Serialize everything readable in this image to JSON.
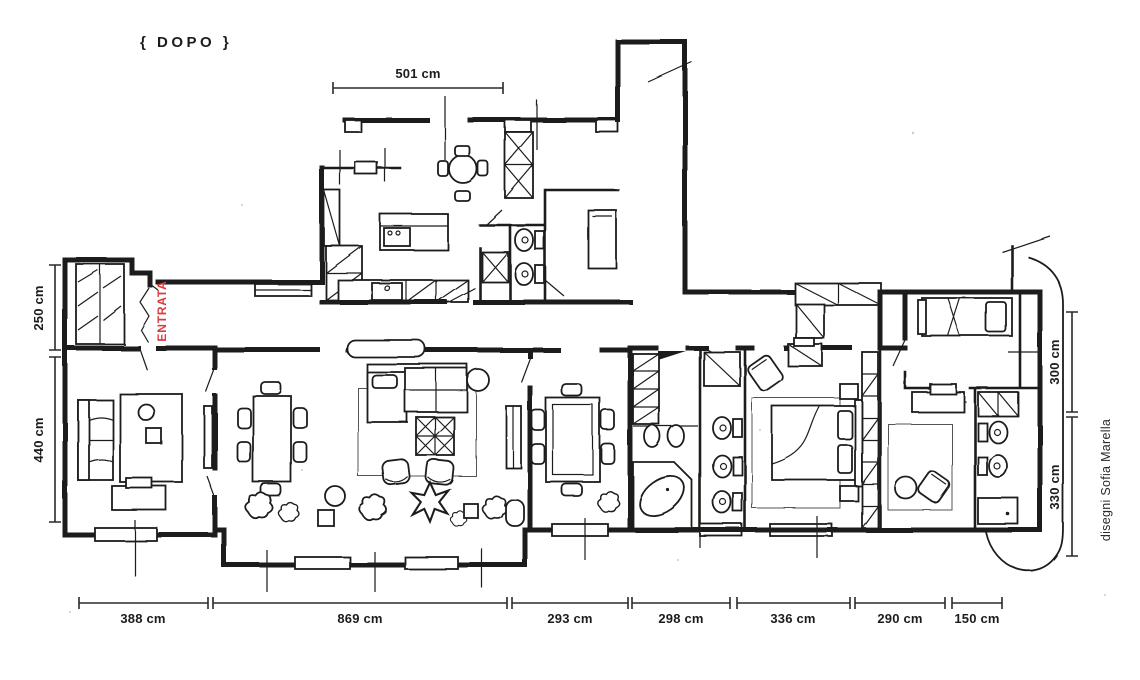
{
  "title": "{ DOPO }",
  "entrance_label": "ENTRATA",
  "credit": "disegni Sofia Marella",
  "unit": "cm",
  "colors": {
    "ink": "#1c1c1a",
    "accent_red": "#d93a42",
    "paper": "#ffffff"
  },
  "dimensions": {
    "top": "501 cm",
    "left_upper": "250 cm",
    "left_lower": "440 cm",
    "right_upper": "300 cm",
    "right_lower": "330 cm",
    "bottom": [
      "388 cm",
      "869 cm",
      "293 cm",
      "298 cm",
      "336 cm",
      "290 cm",
      "150 cm"
    ]
  }
}
